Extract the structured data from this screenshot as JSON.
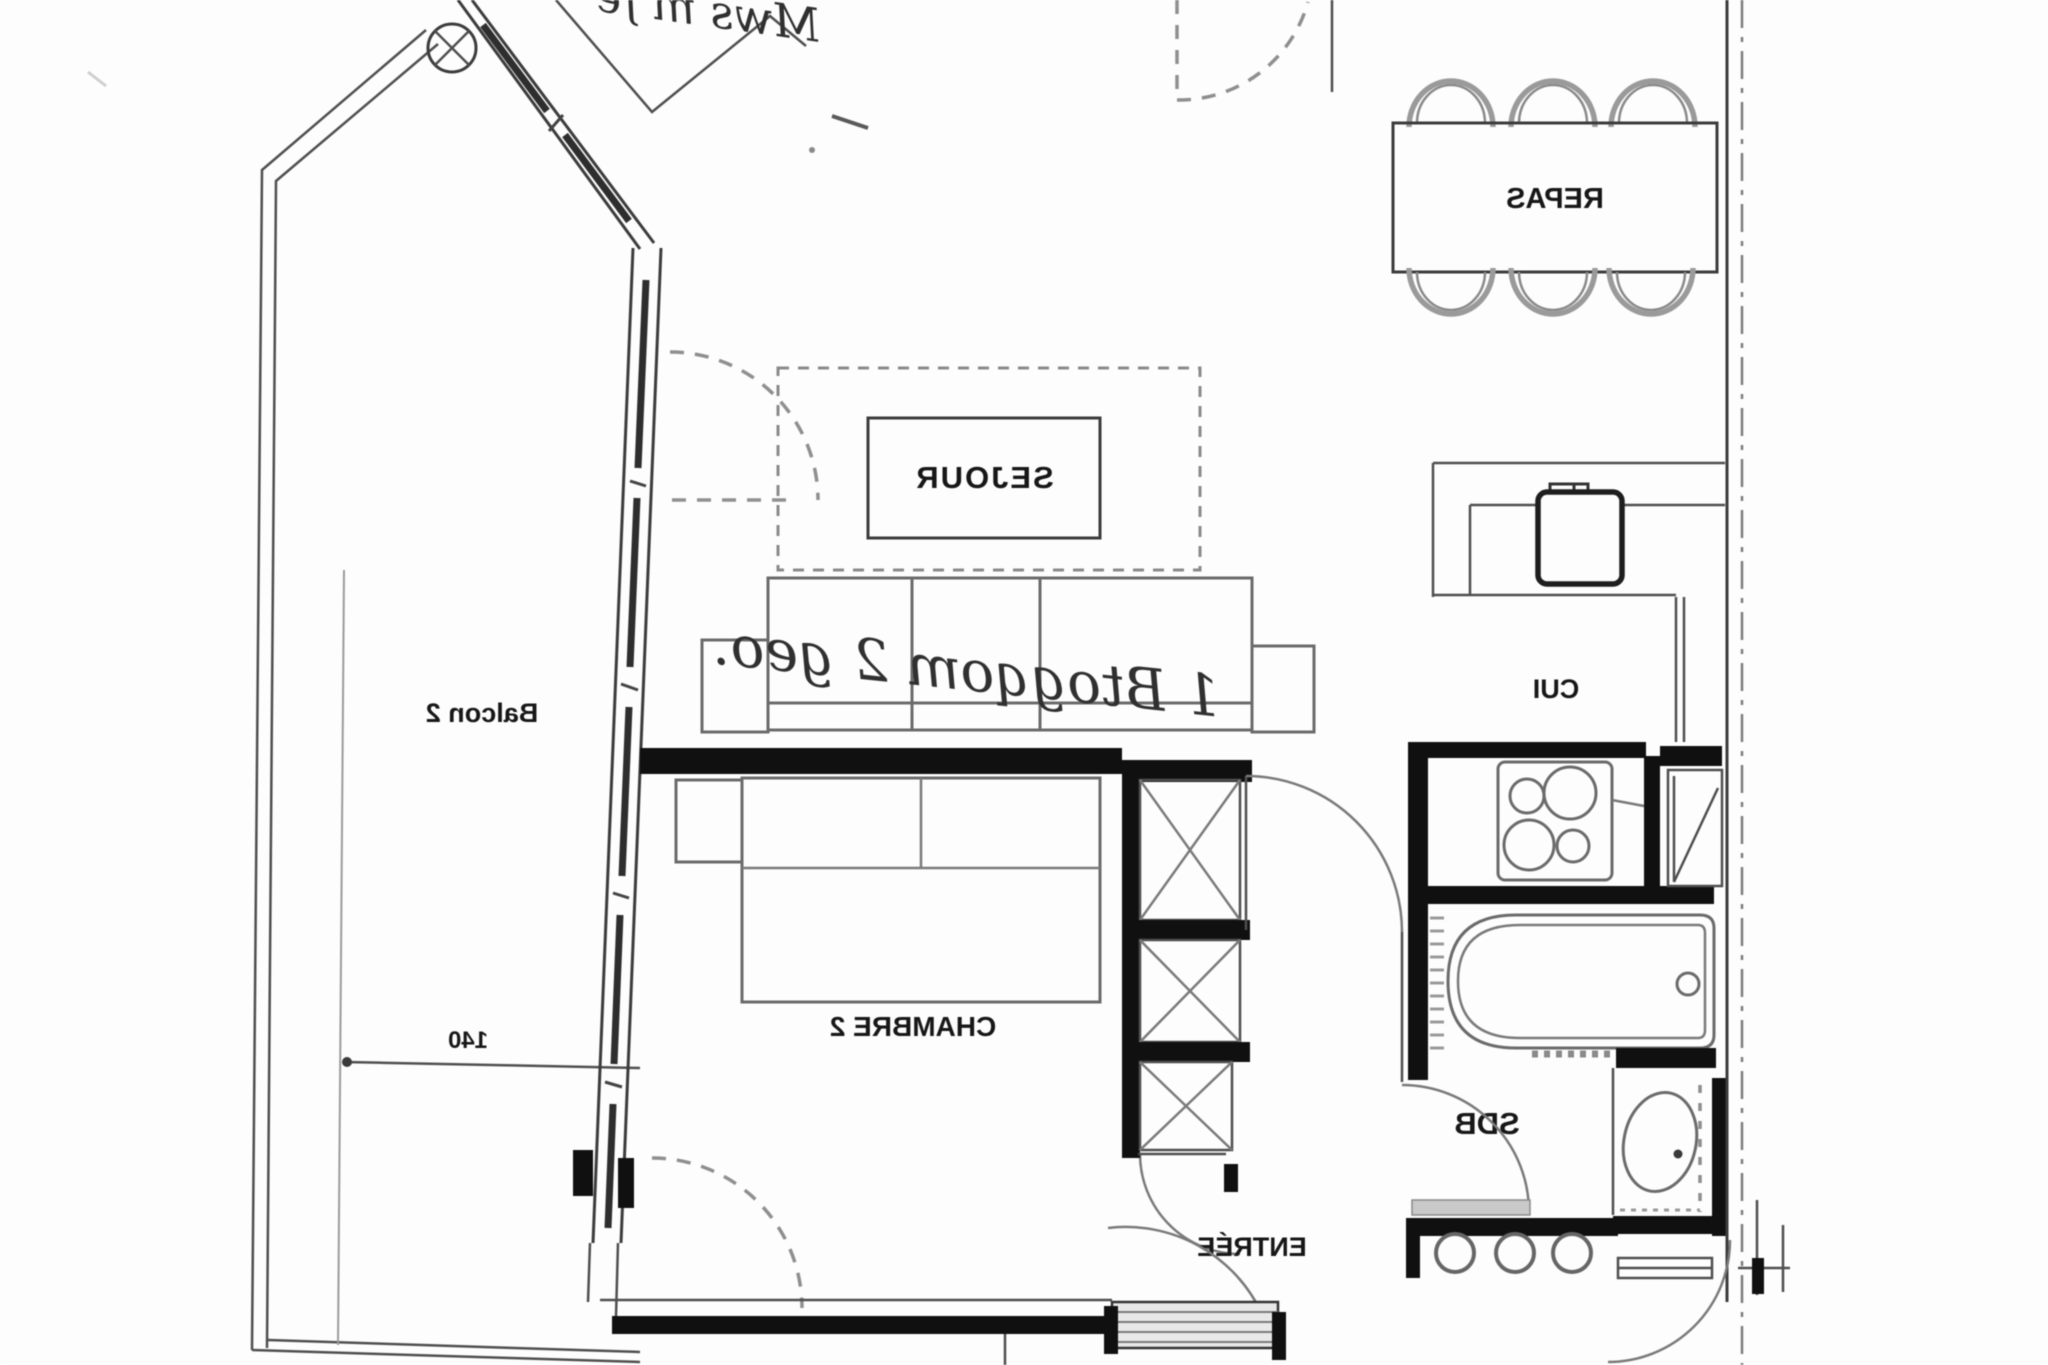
{
  "document": {
    "kind": "scanned architectural floor plan",
    "orientation_note": "all lettering appears mirror-reversed in the scan"
  },
  "rooms": {
    "sejour": {
      "label": "SEJOUR"
    },
    "repas": {
      "label": "REPAS"
    },
    "cuisine": {
      "label": "CUI"
    },
    "chambre_2": {
      "label": "CHAMBRE 2"
    },
    "balcon_2": {
      "label": "Balcon 2"
    },
    "salle_de_bains": {
      "label": "SDB"
    },
    "entree": {
      "label": "ENTRÉE"
    }
  },
  "dimensions": {
    "balcon_depth": "140"
  },
  "annotations": {
    "sofa_note": "1 Btogqom 2 geo.",
    "top_note": "Mws m fe"
  },
  "colors": {
    "paper": "#fdfdfd",
    "thin_line": "#4f4f4f",
    "thick_wall": "#101010",
    "furniture_line": "#6b6b6b",
    "dashed_line": "#8a8a8a"
  }
}
